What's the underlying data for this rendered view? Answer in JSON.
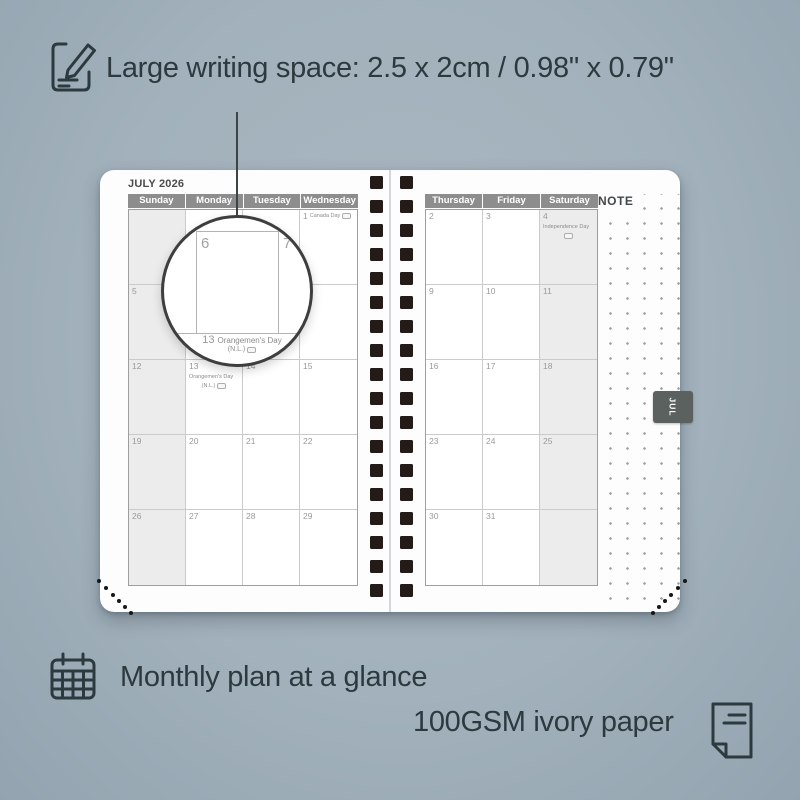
{
  "colors": {
    "background": "#a2b1bb",
    "ink": "#2c3a3f",
    "page": "#fdfdfd",
    "header_gray": "#8d8d8d",
    "weekend_shade": "#ececec",
    "binding_black": "#241b18",
    "tab_gray": "#5b615e"
  },
  "annotations": {
    "writing_space": "Large writing space: 2.5 x 2cm / 0.98\" x 0.79\"",
    "monthly_plan": "Monthly plan at a glance",
    "paper": "100GSM ivory paper"
  },
  "planner": {
    "month_title": "JULY 2026",
    "note_label": "NOTE",
    "month_tab": "JUL",
    "left_page": {
      "day_headers": [
        "Sunday",
        "Monday",
        "Tuesday",
        "Wednesday"
      ],
      "shaded_column": 0,
      "weeks": [
        [
          {
            "day": ""
          },
          {
            "day": ""
          },
          {
            "day": ""
          },
          {
            "day": "1",
            "holiday": "Canada Day",
            "flag": "inline"
          }
        ],
        [
          {
            "day": "5"
          },
          {
            "day": "6"
          },
          {
            "day": "7"
          },
          {
            "day": "8"
          }
        ],
        [
          {
            "day": "12"
          },
          {
            "day": "13",
            "holiday": "Orangemen's Day",
            "sub": "(N.L.)",
            "flag": "below"
          },
          {
            "day": "14"
          },
          {
            "day": "15"
          }
        ],
        [
          {
            "day": "19"
          },
          {
            "day": "20"
          },
          {
            "day": "21"
          },
          {
            "day": "22"
          }
        ],
        [
          {
            "day": "26"
          },
          {
            "day": "27"
          },
          {
            "day": "28"
          },
          {
            "day": "29"
          }
        ]
      ]
    },
    "right_page": {
      "day_headers": [
        "Thursday",
        "Friday",
        "Saturday"
      ],
      "shaded_column": 2,
      "weeks": [
        [
          {
            "day": "2"
          },
          {
            "day": "3"
          },
          {
            "day": "4",
            "holiday": "Independence Day",
            "flag": "below"
          }
        ],
        [
          {
            "day": "9"
          },
          {
            "day": "10"
          },
          {
            "day": "11"
          }
        ],
        [
          {
            "day": "16"
          },
          {
            "day": "17"
          },
          {
            "day": "18"
          }
        ],
        [
          {
            "day": "23"
          },
          {
            "day": "24"
          },
          {
            "day": "25"
          }
        ],
        [
          {
            "day": "30"
          },
          {
            "day": "31"
          },
          {
            "day": ""
          }
        ]
      ]
    },
    "magnifier": {
      "day_a": "6",
      "day_b": "7",
      "below_date": "13",
      "below_holiday": "Orangemen's Day",
      "below_sub": "(N.L.)"
    }
  }
}
